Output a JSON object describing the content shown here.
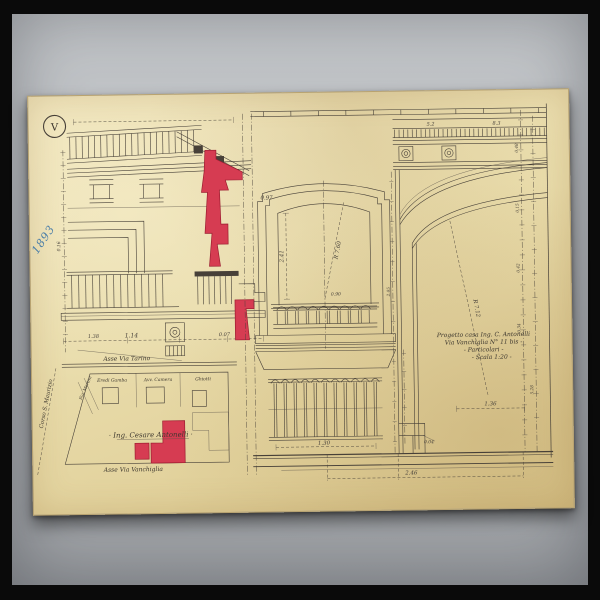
{
  "stamp": {
    "numeral": "V"
  },
  "archive_note": {
    "text": "1893"
  },
  "title_block": {
    "line1": "Progetto casa Ing. C. Antonelli",
    "line2": "Via Vanchiglia N° 11 bis -",
    "line3": "- Particolari -",
    "line4": "- Scala 1:20 -"
  },
  "site_plan": {
    "street_top": "Asse Via Tarino",
    "street_bottom": "Asse Via Vanchiglia",
    "street_left": "Corso S. Maurizio",
    "owner": "· Ing. Cesare Antonelli ·",
    "parcels": [
      "Eredi Gamba",
      "Avv. Camera",
      "Ghiotti"
    ],
    "boundary_note": "Sig. Martini"
  },
  "colors": {
    "paper": "#e9dcab",
    "ink": "#474038",
    "highlight_red": "#d63c52",
    "note_blue": "#4b7ea8",
    "surface_gray": "#b2b5b9"
  },
  "dimensions": [
    {
      "t": "1.14",
      "x": 100,
      "y": 242,
      "s": 6
    },
    {
      "t": "1.38",
      "x": 62,
      "y": 242,
      "s": 5
    },
    {
      "t": "0.07",
      "x": 193,
      "y": 242,
      "s": 5
    },
    {
      "t": "0.97",
      "x": 237,
      "y": 106,
      "s": 5.5
    },
    {
      "t": "0.16",
      "x": 30,
      "y": 150,
      "s": 4.5,
      "r": -90
    },
    {
      "t": "2.41",
      "x": 253,
      "y": 163,
      "s": 5.5,
      "r": -90
    },
    {
      "t": "R 7.60",
      "x": 309,
      "y": 158,
      "s": 5.5,
      "r": -78
    },
    {
      "t": "0.90",
      "x": 305,
      "y": 203,
      "s": 4.5
    },
    {
      "t": "1.30",
      "x": 291,
      "y": 352,
      "s": 5.5
    },
    {
      "t": "5.2",
      "x": 402,
      "y": 34.5,
      "s": 5
    },
    {
      "t": "8.3",
      "x": 468,
      "y": 34.5,
      "s": 5
    },
    {
      "t": "R 7.12",
      "x": 444,
      "y": 218,
      "s": 5.5,
      "r": 80
    },
    {
      "t": "1.36",
      "x": 458,
      "y": 315,
      "s": 5.5
    },
    {
      "t": "0.04",
      "x": 396,
      "y": 352,
      "s": 4.5
    },
    {
      "t": "2.46",
      "x": 378,
      "y": 383,
      "s": 5.5
    },
    {
      "t": "0.48",
      "x": 489,
      "y": 58,
      "s": 4.2,
      "r": -90
    },
    {
      "t": "0.15",
      "x": 489,
      "y": 118,
      "s": 4.2,
      "r": -90
    },
    {
      "t": "0.42",
      "x": 489,
      "y": 178,
      "s": 4.2,
      "r": -90
    },
    {
      "t": "0.34",
      "x": 489,
      "y": 238,
      "s": 4.2,
      "r": -90
    },
    {
      "t": "5.28",
      "x": 501,
      "y": 300,
      "s": 4.2,
      "r": -90
    },
    {
      "t": "2.05",
      "x": 359,
      "y": 200,
      "s": 4.2,
      "r": -90
    }
  ]
}
